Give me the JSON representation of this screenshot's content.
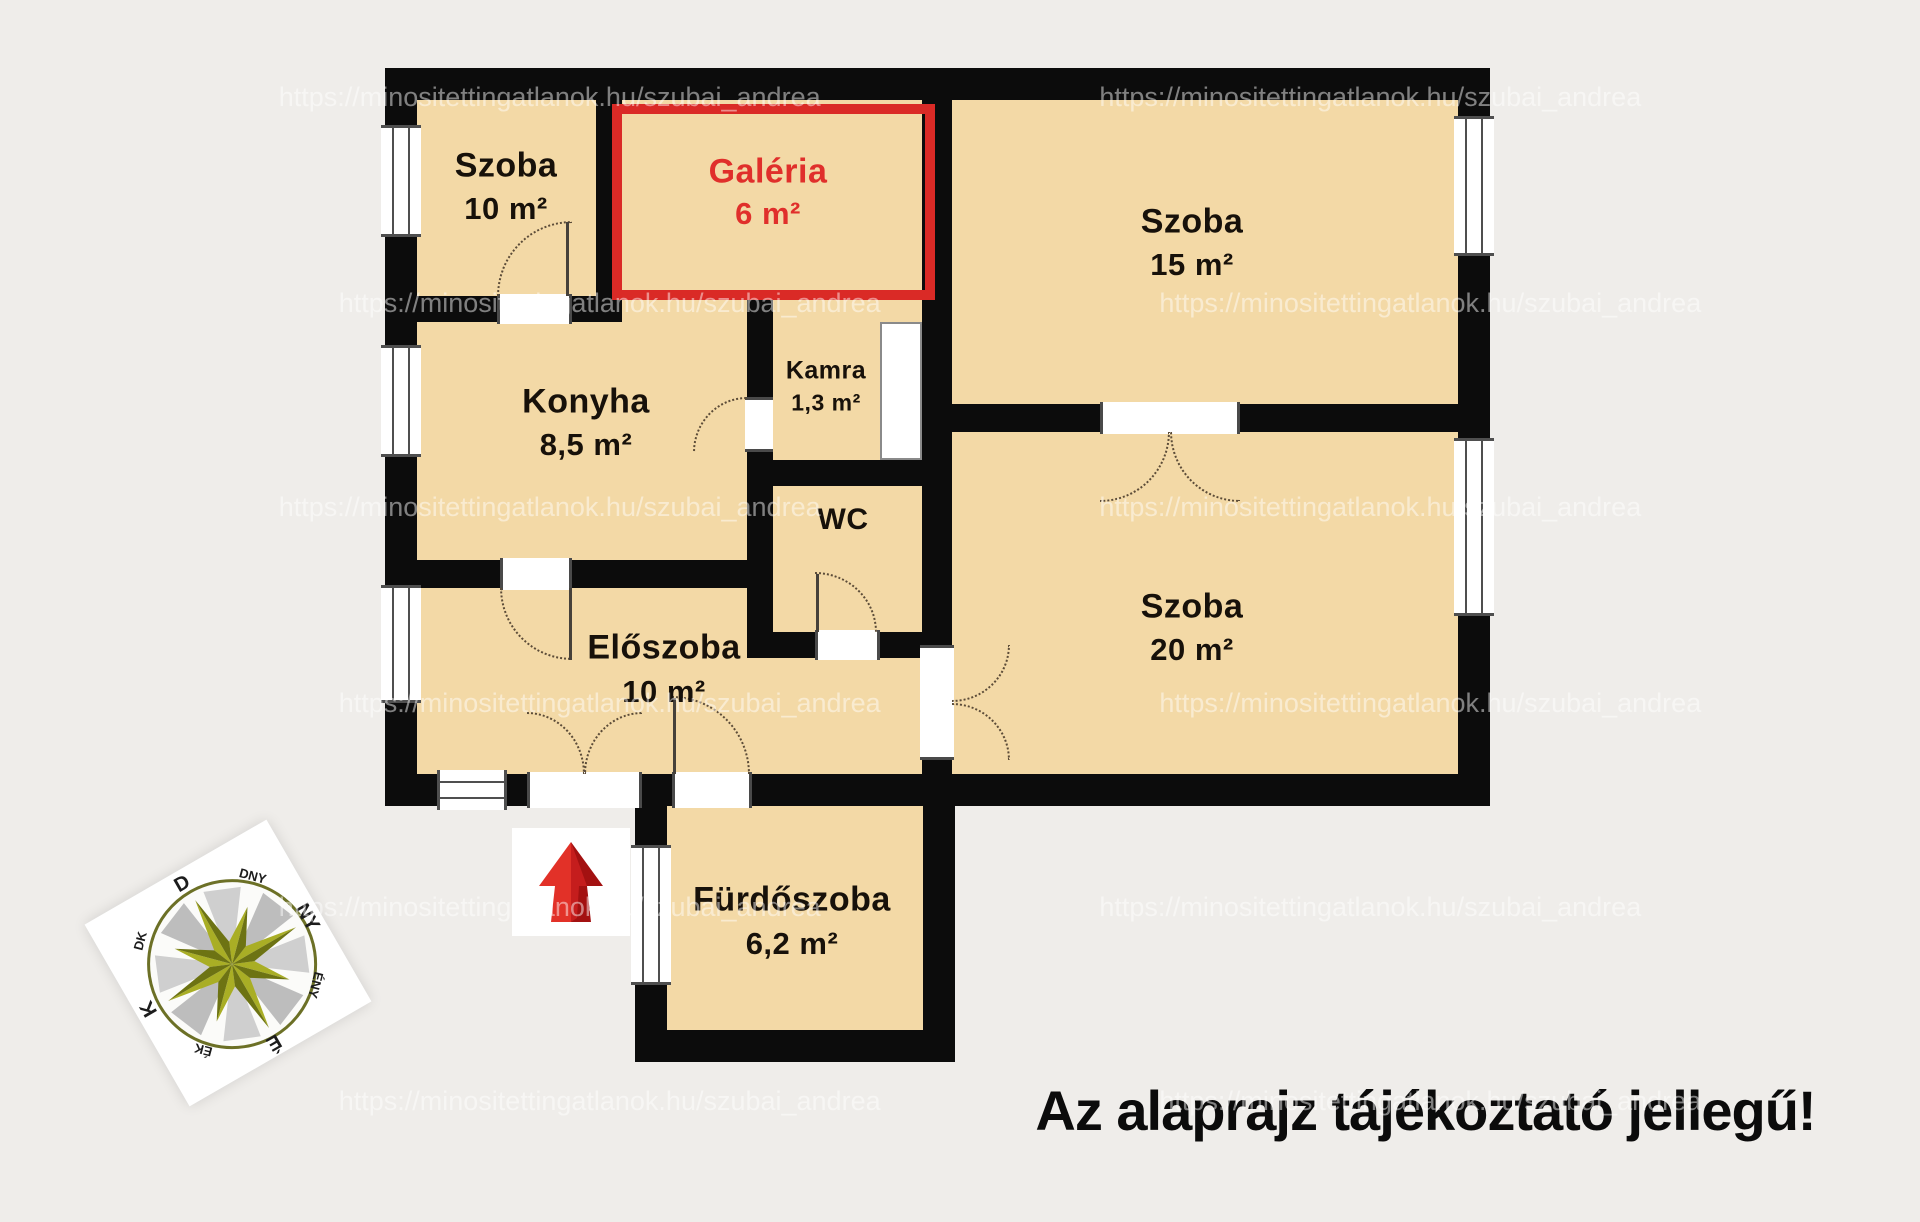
{
  "disclaimer": "Az alaprajz tájékoztató jellegű!",
  "watermark": "https://minositettingatlanok.hu/szubai_andrea",
  "rooms": [
    {
      "name": "Szoba",
      "area": "10 m²"
    },
    {
      "name": "Galéria",
      "area": "6 m²",
      "highlighted": true
    },
    {
      "name": "Szoba",
      "area": "15 m²"
    },
    {
      "name": "Konyha",
      "area": "8,5 m²"
    },
    {
      "name": "Kamra",
      "area": "1,3 m²"
    },
    {
      "name": "WC",
      "area": ""
    },
    {
      "name": "Szoba",
      "area": "20 m²"
    },
    {
      "name": "Előszoba",
      "area": "10 m²"
    },
    {
      "name": "Fürdőszoba",
      "area": "6,2 m²"
    }
  ],
  "compass": {
    "labels": [
      "É",
      "ÉK",
      "K",
      "DK",
      "D",
      "DNY",
      "NY",
      "ÉNY"
    ]
  },
  "colors": {
    "room_fill": "#f3d9a6",
    "wall": "#0c0c0c",
    "highlight_red": "#da2a26",
    "background": "#efedea",
    "arrow_red": "#d31a1a"
  }
}
